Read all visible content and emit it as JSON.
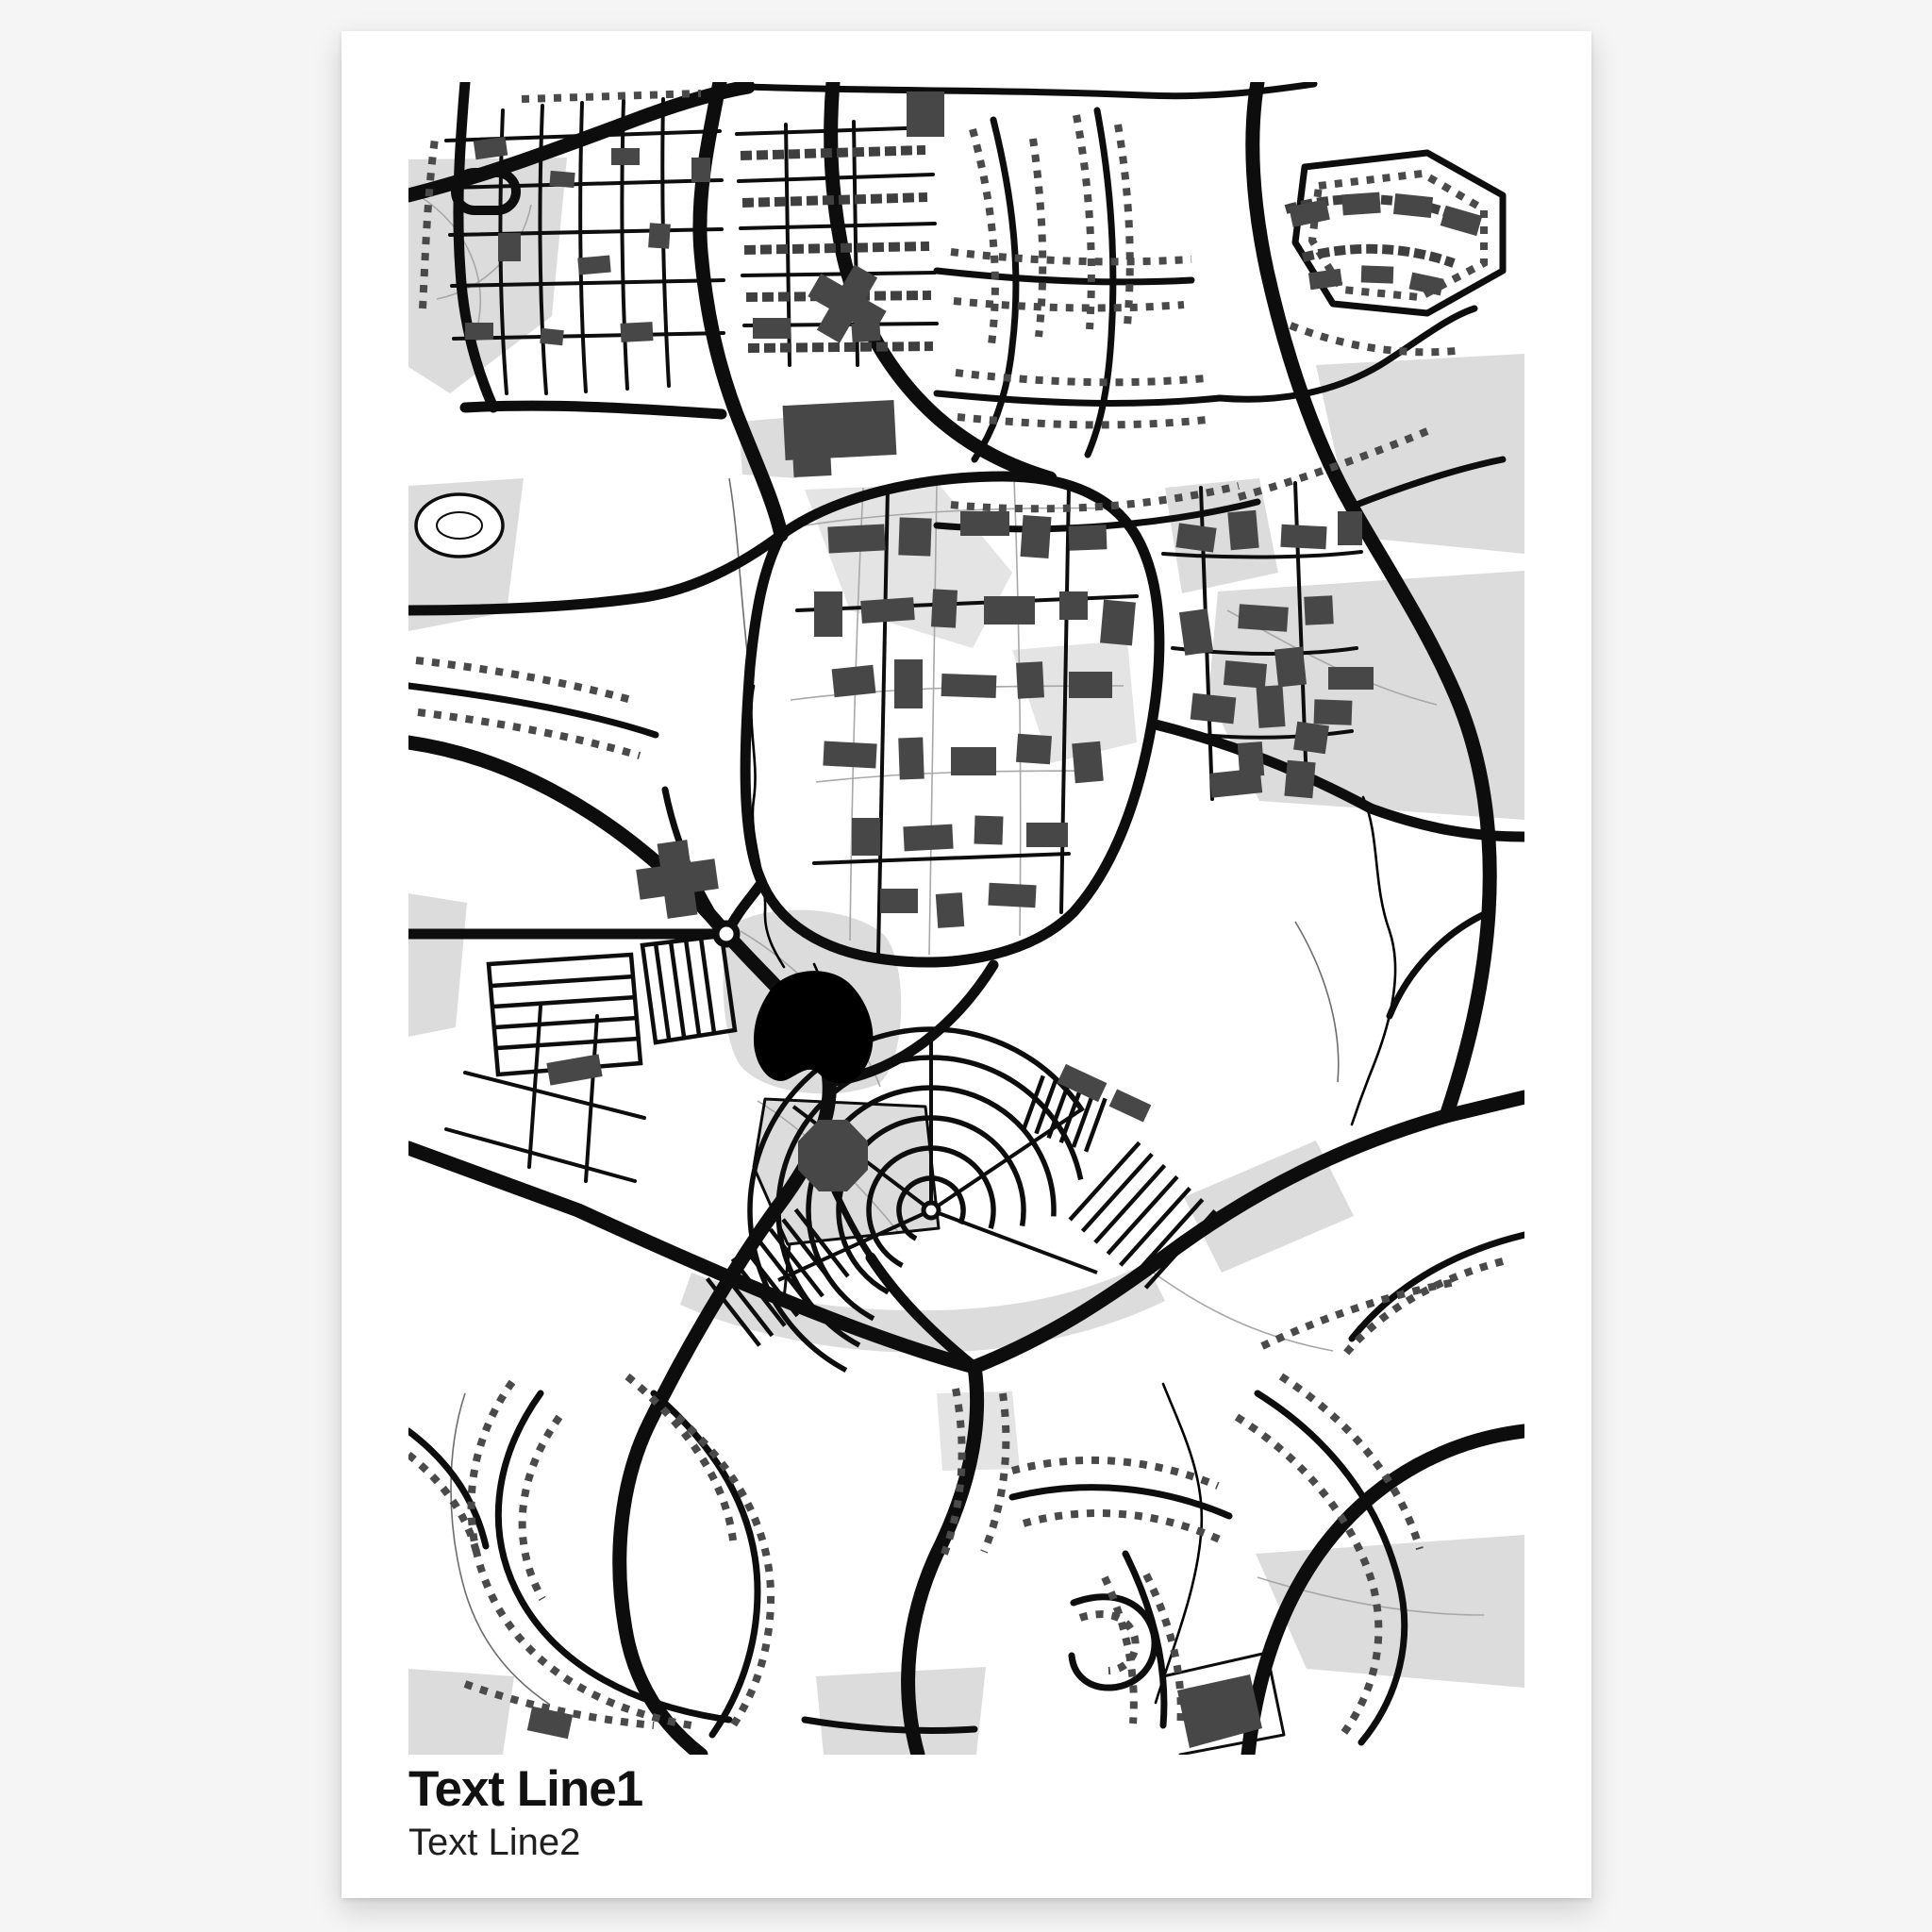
{
  "poster": {
    "title_line1": "Text Line1",
    "title_line2": "Text Line2"
  },
  "map": {
    "style": "monochrome street map poster",
    "landmarks": [
      "campus-ring-road",
      "lake",
      "octagon-building",
      "crescent-streets",
      "suburb-house-rows"
    ]
  },
  "colors": {
    "page_background": "#f5f5f5",
    "poster_background": "#ffffff",
    "map_background": "#ffffff",
    "road": "#0d0d0d",
    "building": "#474747",
    "house_row": "#4a4a4a",
    "green_area": "#dcdcdc",
    "green_area_2": "#e4e4e4",
    "water": "#000000",
    "path": "#a8a8a8",
    "title_text": "#111111",
    "subtitle_text": "#1f1f1f"
  }
}
